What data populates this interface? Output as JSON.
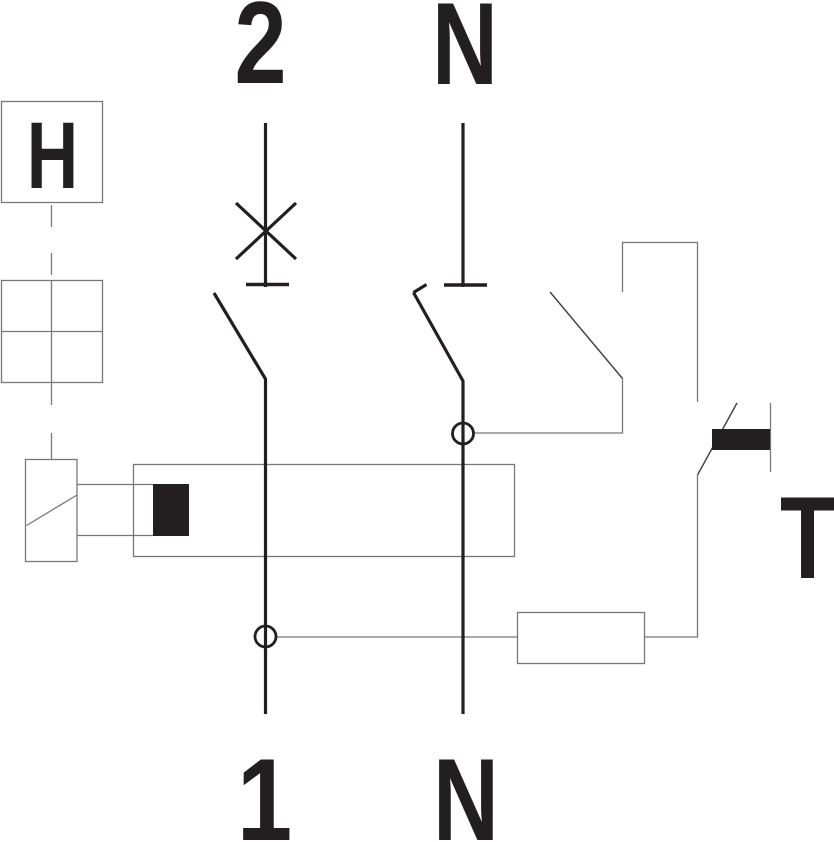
{
  "diagram": {
    "kind": "electrical-wiring-schematic",
    "description": "Two-pole residual current circuit breaker (RCBO/RCD) internal wiring diagram with test circuit"
  },
  "terminals": {
    "top_left": "2",
    "top_right": "N",
    "bottom_left": "1",
    "bottom_right": "N"
  },
  "labels": {
    "handle": "H",
    "test_button": "T"
  },
  "colors": {
    "line_thick": "#231f20",
    "line_thin": "#77787b",
    "line_blade": "#3f4042",
    "background": "#ffffff"
  },
  "components": [
    {
      "name": "handle-indicator-box",
      "symbol": "H in square"
    },
    {
      "name": "mechanism-grid-box",
      "symbol": "2x2 square grid"
    },
    {
      "name": "mechanical-linkage",
      "symbol": "dashed vertical line"
    },
    {
      "name": "trip-relay-box",
      "symbol": "rectangle with diagonal"
    },
    {
      "name": "current-transformer",
      "symbol": "large rectangle over both poles"
    },
    {
      "name": "secondary-winding-block",
      "symbol": "solid black rectangle"
    },
    {
      "name": "pole-2-breaker-contact",
      "symbol": "switch contact with X (circuit-breaker function)"
    },
    {
      "name": "neutral-pole-contact",
      "symbol": "switch contact with hooked blade"
    },
    {
      "name": "rcd-auxiliary-contact",
      "symbol": "open contact to test loop"
    },
    {
      "name": "test-button",
      "symbol": "push button with solid black cap"
    },
    {
      "name": "test-resistor",
      "symbol": "small rectangle"
    },
    {
      "name": "junction-node-pole-1",
      "symbol": "circle node"
    },
    {
      "name": "junction-node-neutral",
      "symbol": "circle node"
    }
  ]
}
